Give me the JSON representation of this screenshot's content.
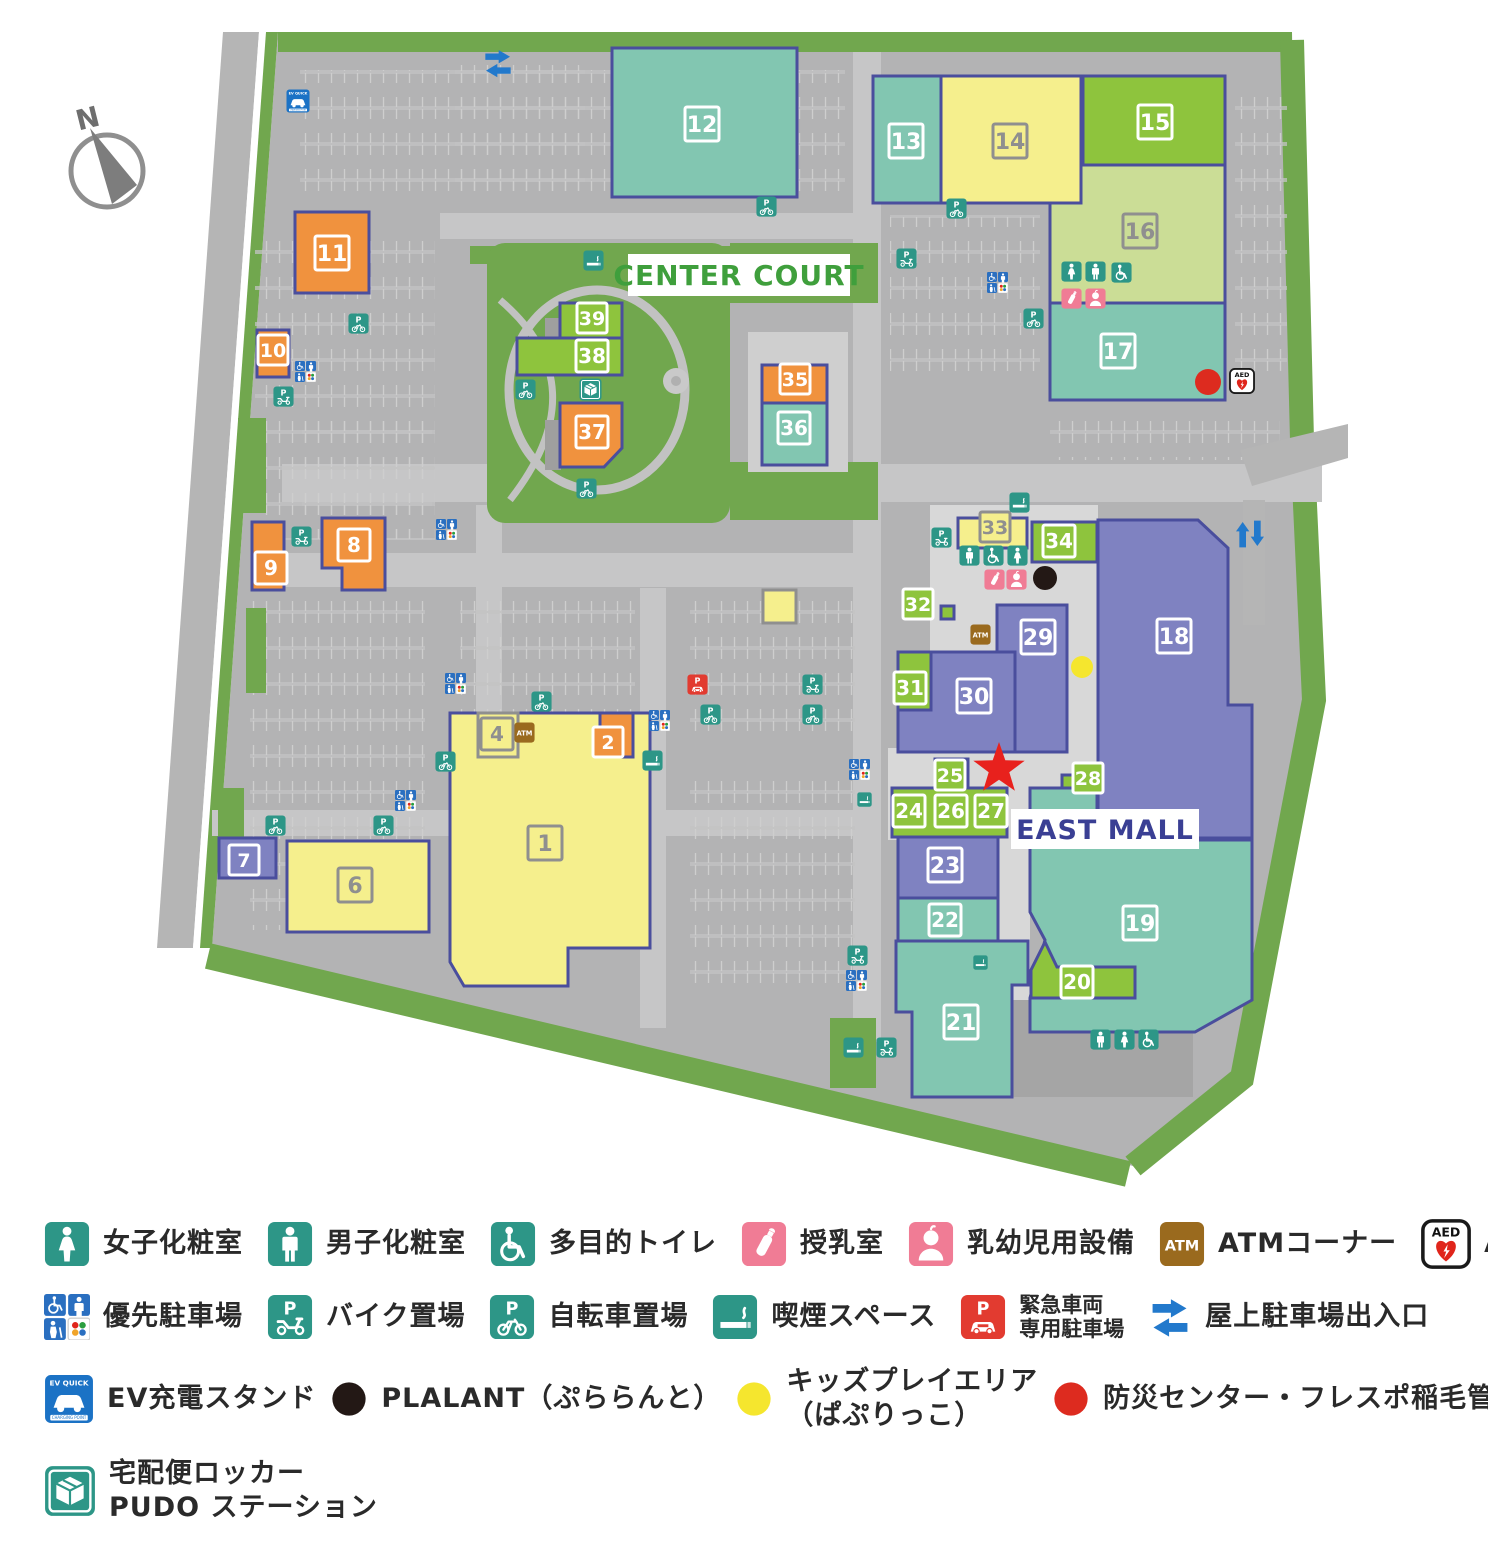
{
  "map": {
    "labels": {
      "center_court": "CENTER COURT",
      "east_mall": "EAST MALL",
      "compass": "N"
    },
    "colors": {
      "teal": "#82c6b1",
      "green": "#8ec43d",
      "lightgreen": "#cbdd96",
      "yellow": "#f5ef8d",
      "orange": "#f0923e",
      "purple": "#7f82c1",
      "outline": "#4a4e9d",
      "gray_outline": "#8f8f8f",
      "icon_teal": "#2d9687",
      "icon_pink": "#f07c95",
      "icon_blue": "#2a6fc0",
      "icon_brown": "#9a6a1e",
      "icon_red": "#e23b30",
      "arrow_blue": "#2279cc",
      "star_red": "#e8211d",
      "dot_black": "#231815",
      "dot_yellow": "#f5e62e",
      "dot_red": "#dd2b1f",
      "center_court_green": "#3f9f3c",
      "east_mall_blue": "#3a3f94",
      "site_gray": "#b3b3b4",
      "road_gray": "#c6c6c7",
      "landscape_green": "#71a74e"
    },
    "buildings": [
      {
        "n": "12",
        "c": "teal",
        "t": "w",
        "r": [
          612,
          48,
          185,
          149
        ],
        "l": [
          702,
          124
        ]
      },
      {
        "n": "13",
        "c": "teal",
        "t": "w",
        "r": [
          873,
          76,
          68,
          127
        ],
        "l": [
          906,
          141
        ]
      },
      {
        "n": "16",
        "c": "lightgreen",
        "t": "g",
        "r": [
          1050,
          165,
          175,
          138
        ],
        "l": [
          1140,
          231
        ]
      },
      {
        "n": "14",
        "c": "yellow",
        "t": "g",
        "r": [
          941,
          76,
          140,
          127
        ],
        "l": [
          1010,
          141
        ]
      },
      {
        "n": "15",
        "c": "green",
        "t": "w",
        "r": [
          1083,
          76,
          142,
          89
        ],
        "l": [
          1155,
          122
        ]
      },
      {
        "n": "17",
        "c": "teal",
        "t": "w",
        "r": [
          1050,
          303,
          175,
          97
        ],
        "l": [
          1118,
          351
        ]
      },
      {
        "n": "11",
        "c": "orange",
        "t": "w",
        "r": [
          295,
          212,
          74,
          81
        ],
        "l": [
          332,
          253
        ]
      },
      {
        "n": "10",
        "c": "orange",
        "t": "w",
        "r": [
          257,
          330,
          32,
          47
        ],
        "l": [
          273,
          350
        ],
        "bs": 30
      },
      {
        "n": "8",
        "c": "orange",
        "t": "w",
        "p": [
          [
            322,
            518
          ],
          [
            385,
            518
          ],
          [
            385,
            590
          ],
          [
            342,
            590
          ],
          [
            342,
            568
          ],
          [
            322,
            568
          ]
        ],
        "l": [
          354,
          545
        ],
        "bs": 32
      },
      {
        "n": "9",
        "c": "orange",
        "t": "w",
        "r": [
          252,
          522,
          32,
          68
        ],
        "l": [
          271,
          568
        ],
        "bs": 32
      },
      {
        "n": "39",
        "c": "green",
        "t": "w",
        "r": [
          560,
          303,
          62,
          35
        ],
        "l": [
          592,
          318
        ],
        "bs": 30
      },
      {
        "n": "38",
        "c": "green",
        "t": "w",
        "r": [
          517,
          338,
          105,
          37
        ],
        "l": [
          592,
          356
        ],
        "bs": 32
      },
      {
        "n": "37",
        "c": "orange",
        "t": "w",
        "p": [
          [
            560,
            403
          ],
          [
            622,
            403
          ],
          [
            622,
            448
          ],
          [
            604,
            467
          ],
          [
            560,
            467
          ]
        ],
        "l": [
          592,
          432
        ],
        "bs": 32
      },
      {
        "n": "35",
        "c": "orange",
        "t": "w",
        "r": [
          762,
          365,
          65,
          38
        ],
        "l": [
          795,
          379
        ],
        "bs": 30
      },
      {
        "n": "36",
        "c": "teal",
        "t": "w",
        "r": [
          762,
          403,
          65,
          62
        ],
        "l": [
          794,
          428
        ],
        "bs": 32
      },
      {
        "n": "",
        "c": "yellow",
        "gb": true,
        "r": [
          763,
          590,
          33,
          33
        ]
      },
      {
        "n": "7",
        "c": "purple",
        "t": "w",
        "r": [
          219,
          838,
          57,
          40
        ],
        "l": [
          244,
          860
        ],
        "bs": 30
      },
      {
        "n": "6",
        "c": "yellow",
        "t": "g",
        "r": [
          287,
          841,
          142,
          91
        ],
        "l": [
          355,
          885
        ]
      },
      {
        "n": "1",
        "c": "yellow",
        "t": "g",
        "p": [
          [
            450,
            713
          ],
          [
            650,
            713
          ],
          [
            650,
            948
          ],
          [
            568,
            948
          ],
          [
            568,
            986
          ],
          [
            464,
            986
          ],
          [
            450,
            962
          ]
        ],
        "l": [
          545,
          843
        ]
      },
      {
        "n": "4",
        "c": "yellow",
        "t": "g",
        "gb": true,
        "r": [
          478,
          713,
          40,
          44
        ],
        "l": [
          497,
          734
        ],
        "bs": 32
      },
      {
        "n": "2",
        "c": "orange",
        "t": "w",
        "r": [
          600,
          713,
          33,
          44
        ],
        "l": [
          608,
          742
        ],
        "bs": 30
      },
      {
        "n": "18",
        "c": "purple",
        "t": "w",
        "p": [
          [
            1098,
            520
          ],
          [
            1198,
            520
          ],
          [
            1228,
            548
          ],
          [
            1228,
            705
          ],
          [
            1252,
            705
          ],
          [
            1252,
            838
          ],
          [
            1098,
            838
          ]
        ],
        "l": [
          1174,
          636
        ]
      },
      {
        "n": "33",
        "c": "yellow",
        "t": "g",
        "r": [
          958,
          518,
          69,
          30
        ],
        "l": [
          995,
          527
        ],
        "bs": 30
      },
      {
        "n": "34",
        "c": "green",
        "t": "w",
        "r": [
          1032,
          522,
          65,
          40
        ],
        "l": [
          1059,
          541
        ],
        "bs": 32
      },
      {
        "n": "32",
        "c": "green",
        "t": "w",
        "r": [
          941,
          606,
          13,
          13
        ],
        "l": [
          918,
          604
        ],
        "bs": 30
      },
      {
        "n": "29",
        "c": "purple",
        "t": "w",
        "r": [
          997,
          605,
          70,
          147
        ],
        "l": [
          1038,
          637
        ]
      },
      {
        "n": "30",
        "c": "purple",
        "t": "w",
        "r": [
          898,
          652,
          117,
          100
        ],
        "l": [
          974,
          696
        ]
      },
      {
        "n": "31",
        "c": "green",
        "t": "w",
        "r": [
          898,
          652,
          33,
          58
        ],
        "l": [
          910,
          688
        ],
        "bs": 32
      },
      {
        "n": "25",
        "c": "green",
        "t": "w",
        "r": [
          935,
          759,
          33,
          33
        ],
        "l": [
          950,
          775
        ],
        "bs": 30
      },
      {
        "n": "24",
        "c": "green",
        "t": "w",
        "r": [
          892,
          788,
          115,
          49
        ],
        "l": [
          909,
          811
        ],
        "bs": 32
      },
      {
        "n": "26",
        "c": "green",
        "t": "w",
        "l": [
          951,
          811
        ],
        "bs": 32
      },
      {
        "n": "27",
        "c": "green",
        "t": "w",
        "l": [
          991,
          811
        ],
        "bs": 32
      },
      {
        "n": "28",
        "c": "green",
        "t": "w",
        "r": [
          1062,
          775,
          16,
          16
        ],
        "l": [
          1088,
          778
        ],
        "bs": 30
      },
      {
        "n": "23",
        "c": "purple",
        "t": "w",
        "r": [
          898,
          837,
          100,
          61
        ],
        "l": [
          945,
          865
        ]
      },
      {
        "n": "22",
        "c": "teal",
        "t": "w",
        "r": [
          898,
          898,
          100,
          43
        ],
        "l": [
          945,
          920
        ],
        "bs": 32
      },
      {
        "n": "21",
        "c": "teal",
        "t": "w",
        "p": [
          [
            896,
            941
          ],
          [
            1028,
            941
          ],
          [
            1028,
            985
          ],
          [
            1012,
            985
          ],
          [
            1012,
            1097
          ],
          [
            912,
            1097
          ],
          [
            912,
            1012
          ],
          [
            896,
            1012
          ]
        ],
        "l": [
          961,
          1022
        ]
      },
      {
        "n": "19",
        "c": "teal",
        "t": "w",
        "p": [
          [
            1030,
            788
          ],
          [
            1097,
            788
          ],
          [
            1097,
            840
          ],
          [
            1252,
            840
          ],
          [
            1252,
            1000
          ],
          [
            1195,
            1032
          ],
          [
            1030,
            1032
          ],
          [
            1030,
            998
          ],
          [
            1045,
            940
          ],
          [
            1030,
            912
          ]
        ],
        "l": [
          1140,
          923
        ]
      },
      {
        "n": "20",
        "c": "green",
        "t": "w",
        "p": [
          [
            1031,
            998
          ],
          [
            1031,
            970
          ],
          [
            1045,
            942
          ],
          [
            1057,
            967
          ],
          [
            1135,
            967
          ],
          [
            1135,
            998
          ]
        ],
        "l": [
          1077,
          982
        ],
        "bs": 32
      }
    ],
    "icons": [
      {
        "t": "ev",
        "x": 286,
        "y": 89,
        "s": 24
      },
      {
        "t": "arr-h",
        "x": 482,
        "y": 47,
        "s": 32
      },
      {
        "t": "p-bike",
        "x": 348,
        "y": 313
      },
      {
        "t": "priority",
        "x": 295,
        "y": 361
      },
      {
        "t": "p-moto",
        "x": 273,
        "y": 386
      },
      {
        "t": "p-moto",
        "x": 291,
        "y": 526
      },
      {
        "t": "smoke",
        "x": 583,
        "y": 250
      },
      {
        "t": "p-bike",
        "x": 756,
        "y": 196
      },
      {
        "t": "p-bike",
        "x": 946,
        "y": 198
      },
      {
        "t": "p-moto",
        "x": 896,
        "y": 248
      },
      {
        "t": "priority",
        "x": 987,
        "y": 272
      },
      {
        "t": "p-bike",
        "x": 1023,
        "y": 308
      },
      {
        "t": "toilet-w",
        "x": 1061,
        "y": 261
      },
      {
        "t": "toilet-m",
        "x": 1085,
        "y": 261
      },
      {
        "t": "toilet-multi",
        "x": 1111,
        "y": 262
      },
      {
        "t": "nursing",
        "x": 1061,
        "y": 288
      },
      {
        "t": "infant",
        "x": 1085,
        "y": 288
      },
      {
        "t": "aed",
        "x": 1229,
        "y": 368,
        "s": 26
      },
      {
        "t": "p-bike",
        "x": 515,
        "y": 379
      },
      {
        "t": "pudo",
        "x": 579,
        "y": 378,
        "s": 23
      },
      {
        "t": "p-bike",
        "x": 576,
        "y": 478
      },
      {
        "t": "priority",
        "x": 436,
        "y": 519
      },
      {
        "t": "priority",
        "x": 445,
        "y": 673
      },
      {
        "t": "p-bike",
        "x": 531,
        "y": 691
      },
      {
        "t": "p-bike",
        "x": 435,
        "y": 751
      },
      {
        "t": "priority",
        "x": 395,
        "y": 790
      },
      {
        "t": "p-bike",
        "x": 265,
        "y": 815
      },
      {
        "t": "p-bike",
        "x": 373,
        "y": 815
      },
      {
        "t": "priority",
        "x": 649,
        "y": 710
      },
      {
        "t": "smoke",
        "x": 642,
        "y": 750
      },
      {
        "t": "p-car",
        "x": 687,
        "y": 674
      },
      {
        "t": "p-moto",
        "x": 802,
        "y": 674
      },
      {
        "t": "p-bike",
        "x": 700,
        "y": 704
      },
      {
        "t": "p-bike",
        "x": 802,
        "y": 704
      },
      {
        "t": "priority",
        "x": 849,
        "y": 759
      },
      {
        "t": "smoke",
        "x": 857,
        "y": 792,
        "s": 15
      },
      {
        "t": "smoke",
        "x": 1009,
        "y": 492
      },
      {
        "t": "p-moto",
        "x": 931,
        "y": 527
      },
      {
        "t": "toilet-m",
        "x": 959,
        "y": 545
      },
      {
        "t": "toilet-multi",
        "x": 983,
        "y": 545
      },
      {
        "t": "toilet-w",
        "x": 1007,
        "y": 545
      },
      {
        "t": "nursing",
        "x": 984,
        "y": 569
      },
      {
        "t": "infant",
        "x": 1006,
        "y": 569
      },
      {
        "t": "atm",
        "x": 970,
        "y": 624
      },
      {
        "t": "arr-v",
        "x": 1234,
        "y": 518,
        "s": 32
      },
      {
        "t": "smoke",
        "x": 973,
        "y": 955,
        "s": 15
      },
      {
        "t": "p-moto",
        "x": 847,
        "y": 945
      },
      {
        "t": "priority",
        "x": 846,
        "y": 970
      },
      {
        "t": "smoke",
        "x": 843,
        "y": 1037
      },
      {
        "t": "p-moto",
        "x": 876,
        "y": 1037
      },
      {
        "t": "toilet-m",
        "x": 1090,
        "y": 1029
      },
      {
        "t": "toilet-w",
        "x": 1114,
        "y": 1029
      },
      {
        "t": "toilet-multi",
        "x": 1138,
        "y": 1029
      },
      {
        "t": "atm",
        "x": 514,
        "y": 722
      }
    ],
    "markers": [
      {
        "t": "dot-black",
        "x": 1045,
        "y": 578,
        "r": 12
      },
      {
        "t": "dot-yellow",
        "x": 1082,
        "y": 667,
        "r": 11
      },
      {
        "t": "dot-red",
        "x": 1208,
        "y": 382,
        "r": 13
      },
      {
        "t": "star",
        "x": 999,
        "y": 769,
        "r": 27
      }
    ]
  },
  "legend": {
    "rows": [
      {
        "items": [
          {
            "icon": "toilet-w",
            "label": "女子化粧室"
          },
          {
            "icon": "toilet-m",
            "label": "男子化粧室"
          },
          {
            "icon": "toilet-multi",
            "label": "多目的トイレ"
          },
          {
            "icon": "nursing",
            "label": "授乳室"
          },
          {
            "icon": "infant",
            "label": "乳幼児用設備"
          },
          {
            "icon": "atm",
            "label": "ATMコーナー"
          },
          {
            "icon": "aed",
            "label": "AED"
          }
        ]
      },
      {
        "items": [
          {
            "icon": "priority",
            "label": "優先駐車場"
          },
          {
            "icon": "p-moto",
            "label": "バイク置場"
          },
          {
            "icon": "p-bike",
            "label": "自転車置場"
          },
          {
            "icon": "smoke",
            "label": "喫煙スペース"
          },
          {
            "icon": "p-car",
            "label": "緊急車両",
            "label2": "専用駐車場",
            "small": true
          },
          {
            "icon": "arr-h",
            "label": "屋上駐車場出入口"
          }
        ]
      },
      {
        "items": [
          {
            "icon": "ev",
            "label": "EV充電スタンド"
          },
          {
            "icon": "dot-black",
            "label": "PLALANT（ぷららんと）"
          },
          {
            "icon": "dot-yellow",
            "label": "キッズプレイエリア",
            "label2": "（ぱぷりっこ）"
          },
          {
            "icon": "dot-red",
            "label": "防災センター・フレスポ稲毛管理事務所"
          }
        ]
      },
      {
        "items": [
          {
            "icon": "pudo",
            "label": "宅配便ロッカー",
            "label2": "PUDO ステーション"
          }
        ]
      }
    ]
  }
}
